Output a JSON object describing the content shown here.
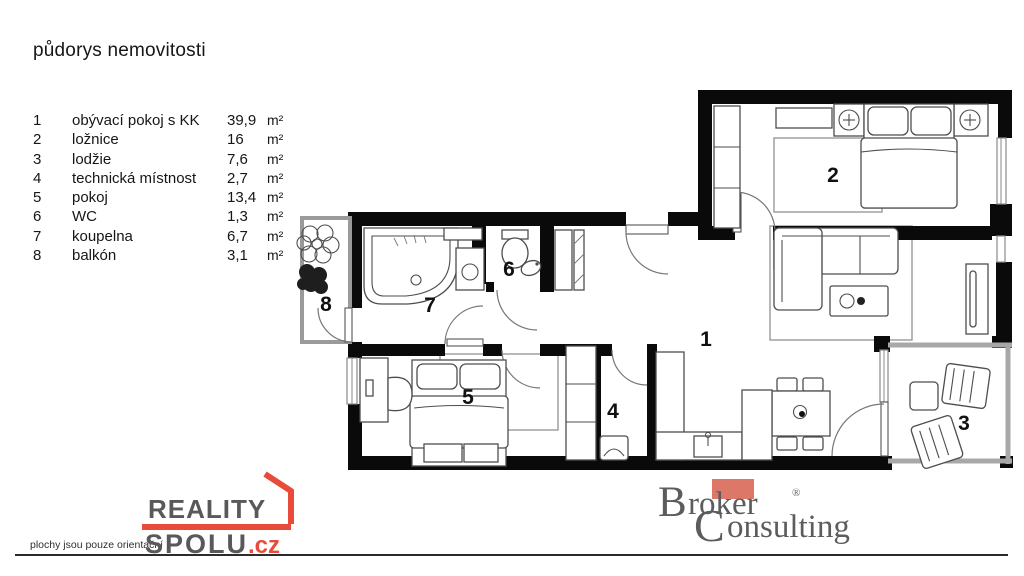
{
  "title": "půdorys nemovitosti",
  "legend": {
    "items": [
      {
        "num": "1",
        "name": "obývací pokoj s KK",
        "value": "39,9",
        "unit": "m²"
      },
      {
        "num": "2",
        "name": "ložnice",
        "value": "16",
        "unit": "m²"
      },
      {
        "num": "3",
        "name": "lodžie",
        "value": "7,6",
        "unit": "m²"
      },
      {
        "num": "4",
        "name": "technická místnost",
        "value": "2,7",
        "unit": "m²"
      },
      {
        "num": "5",
        "name": "pokoj",
        "value": "13,4",
        "unit": "m²"
      },
      {
        "num": "6",
        "name": "WC",
        "value": "1,3",
        "unit": "m²"
      },
      {
        "num": "7",
        "name": "koupelna",
        "value": "6,7",
        "unit": "m²"
      },
      {
        "num": "8",
        "name": "balkón",
        "value": "3,1",
        "unit": "m²"
      }
    ]
  },
  "plan": {
    "room_labels": [
      {
        "room": "obývací pokoj s KK",
        "text": "1"
      },
      {
        "room": "ložnice",
        "text": "2"
      },
      {
        "room": "lodžie",
        "text": "3"
      },
      {
        "room": "technická místnost",
        "text": "4"
      },
      {
        "room": "pokoj",
        "text": "5"
      },
      {
        "room": "WC",
        "text": "6"
      },
      {
        "room": "koupelna",
        "text": "7"
      },
      {
        "room": "balkón",
        "text": "8"
      }
    ]
  },
  "footer": {
    "disclaimer": "plochy jsou pouze orientační",
    "reality_logo": {
      "line1": "REALITY",
      "line2": "SPOLU",
      "tld": ".cz"
    },
    "broker_logo": {
      "b_initial": "B",
      "word1_rest": "roker",
      "registered": "®",
      "c_initial": "C",
      "word2_rest": "onsulting"
    }
  },
  "colors": {
    "accent_red": "#e84b3a",
    "logo_gray": "#58595b",
    "broker_salmon": "#dd7767",
    "wall_black": "#0a0a0a"
  }
}
